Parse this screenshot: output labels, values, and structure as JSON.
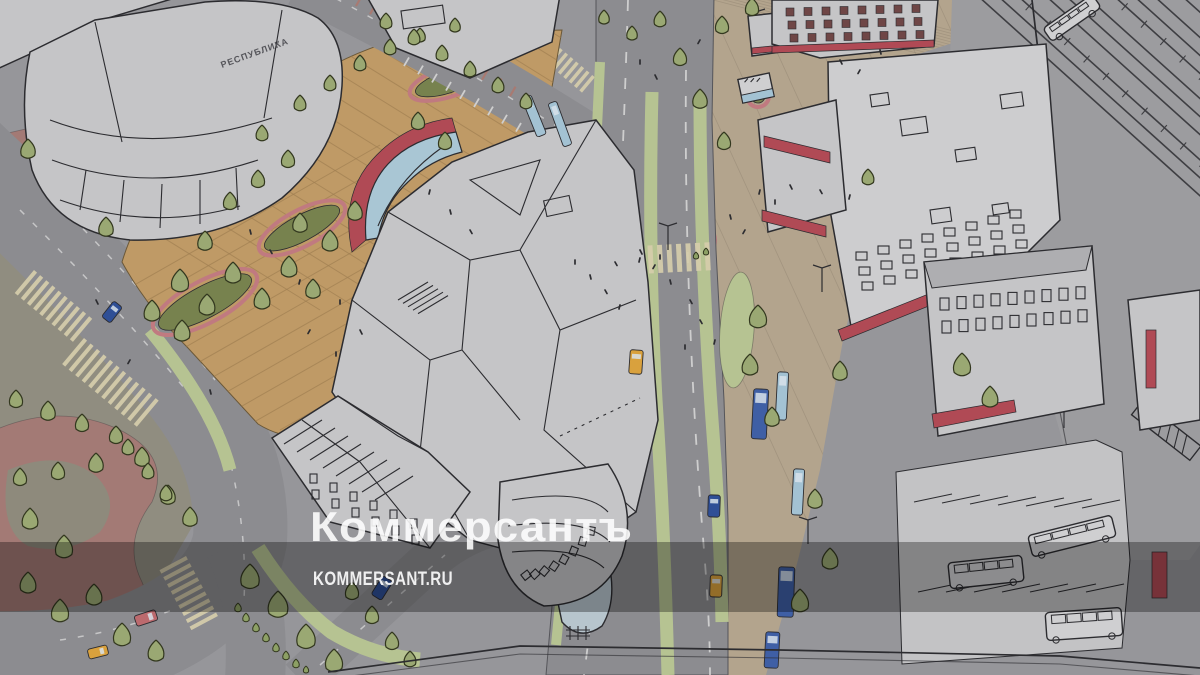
{
  "image": {
    "description": "Hand-drawn aerial architectural rendering of a redesigned station square: pedestrian plaza with planters, a landscaped avenue with buses and taxis, city blocks, a bus parking lot and railway tracks",
    "building_sign": "РЕСПУБЛИКА"
  },
  "watermark": {
    "title": "Коммерсантъ",
    "domain": "KOMMERSANT.RU",
    "color": "#ffffff",
    "band_color": "#000000",
    "band_opacity": "0.32"
  },
  "palette": {
    "base": "#96969a",
    "rail_bg": "#9c9c9f",
    "rail_line": "#3e3e42",
    "road": "#8c8c90",
    "parking": "#c3c3c5",
    "beige": "#b3a48d",
    "plaza": "#bf9a66",
    "plaza_line": "#a07f52",
    "park": "#908d80",
    "park_path": "#a37a75",
    "verge": "#b6c392",
    "tree": "#9aa873",
    "bush": "#8da065",
    "building": "#c5c5c7",
    "roof": "#aeaeb1",
    "ink": "#2c2c30",
    "red": "#b04a55",
    "maroon": "#6f4646",
    "zebra": "#d6cdab",
    "dash": "#d9d9d9",
    "bus": "#3f5fa5",
    "car_blue": "#2f4f96",
    "taxi": "#d9a13d",
    "car_red": "#bc6a6e",
    "shelter": "#a3c2d3",
    "canopy": "#b7c5cd",
    "glass": "#a9c6d4",
    "planter": "#77824e",
    "planter_rim": "#c07a80"
  }
}
